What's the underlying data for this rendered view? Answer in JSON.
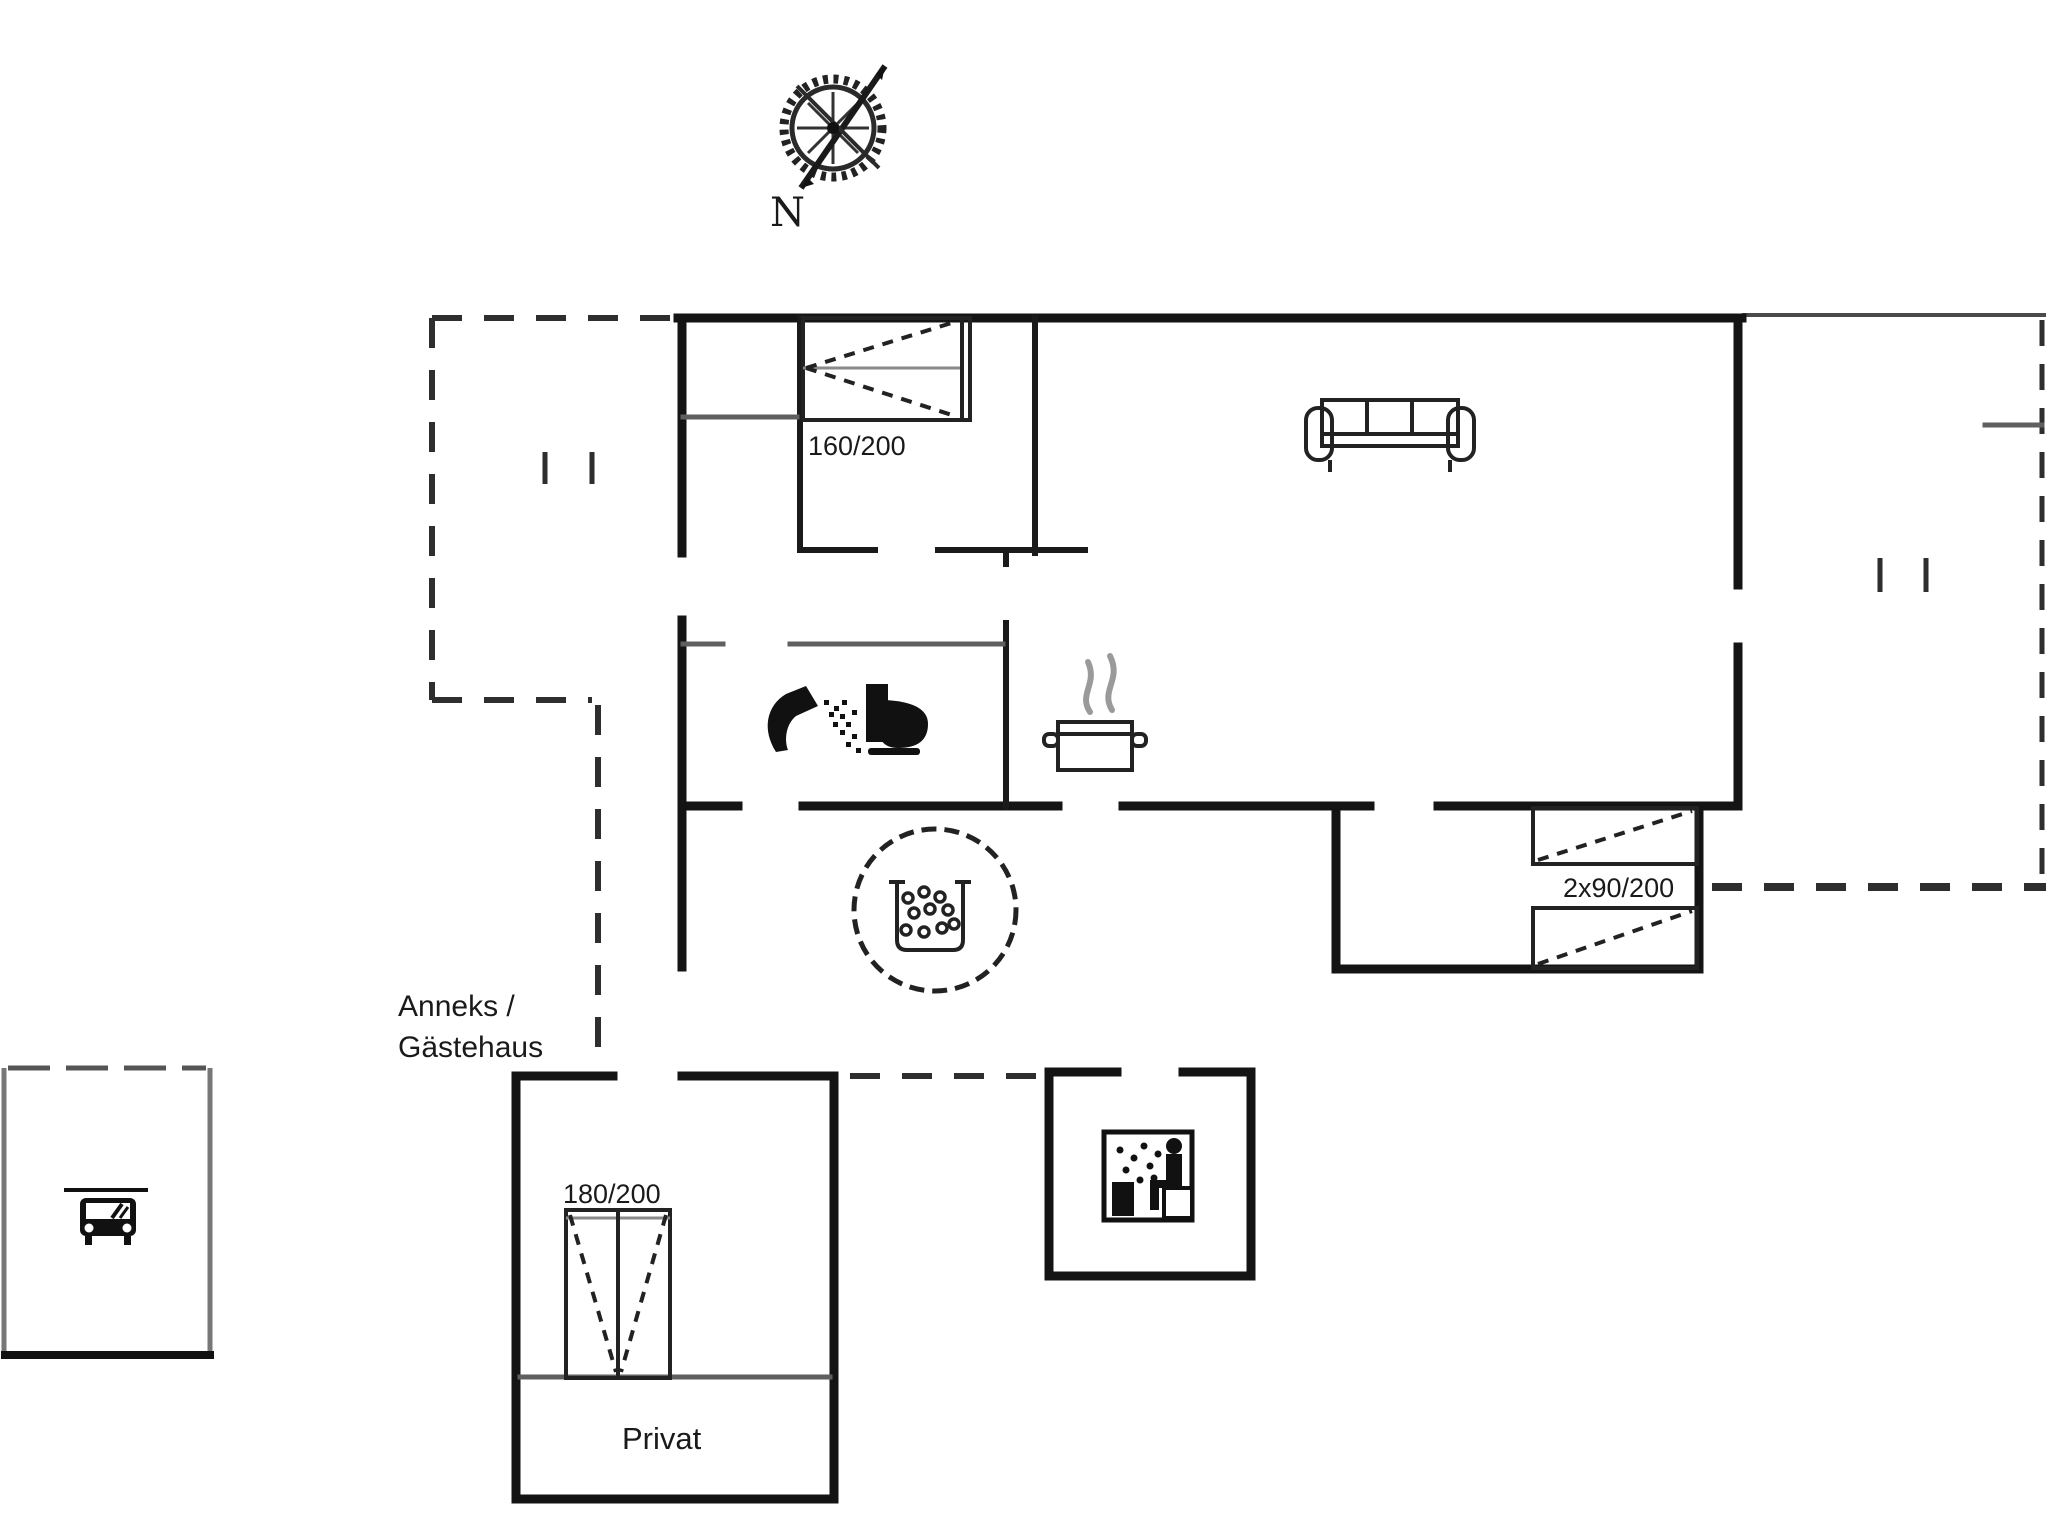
{
  "compass": {
    "label": "N",
    "icon": "compass-rose-icon"
  },
  "main_house": {
    "bedroom": {
      "bed_label": "160/200",
      "bed_icon": "double-bed-icon"
    },
    "living_room": {
      "sofa_icon": "sofa-icon"
    },
    "kitchen": {
      "stove_icon": "steaming-pot-icon"
    },
    "bathroom": {
      "shower_icon": "shower-icon",
      "toilet_icon": "toilet-icon"
    },
    "bunk_room": {
      "bed_label": "2x90/200",
      "beds_icon": "twin-beds-icon"
    }
  },
  "terrace": {
    "whirlpool_icon": "whirlpool-bubbles-icon"
  },
  "annex": {
    "name_line1": "Anneks /",
    "name_line2": "Gästehaus",
    "bedroom": {
      "bed_label": "180/200",
      "bed_icon": "double-bed-icon"
    },
    "private_area_label": "Privat"
  },
  "sauna": {
    "icon": "sauna-person-icon"
  },
  "carport": {
    "icon": "car-icon"
  },
  "colors": {
    "walls": "#141414",
    "interior_walls": "#5f5f5f",
    "dashed_lines": "#2e2e2e",
    "steam": "#9a9a9a",
    "background": "#ffffff"
  }
}
